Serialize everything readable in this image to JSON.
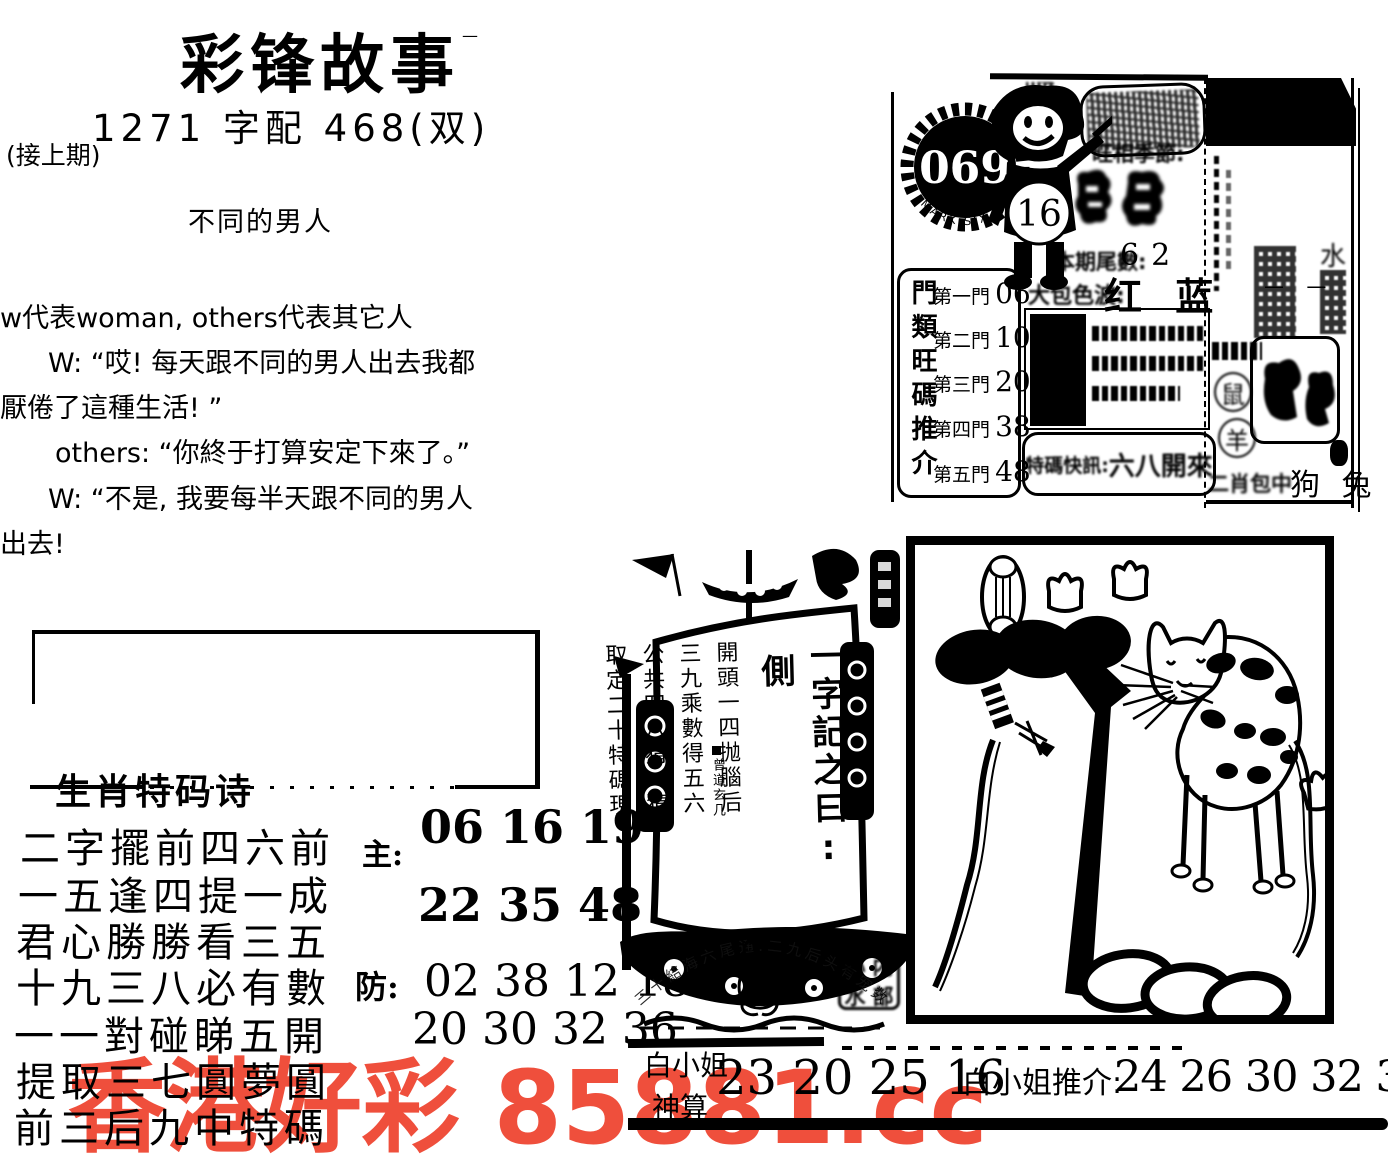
{
  "masthead": {
    "title": "彩锋故事",
    "title_dash": "—",
    "subtitle": "1271 字配 468(双)",
    "continued": "(接上期)",
    "episode_title": "不同的男人"
  },
  "story": {
    "intro": "w代表woman, others代表其它人",
    "lines": [
      "W: “哎! 每天跟不同的男人出去我都",
      "厭倦了這種生活! ”",
      "others: “你終于打算安定下來了。”",
      "W: “不是, 我要每半天跟不同的男人",
      "出去!"
    ]
  },
  "info_panel": {
    "issue_number": "069",
    "ring_text": "MARK SIX",
    "boy_number": "16",
    "zodiac_label": "旺相季節:",
    "tail_label": "本期尾數:",
    "tail_value": "62",
    "wave_label": "大包色波:",
    "wave_values": "红 蓝",
    "gates_title": "門類旺碼推介",
    "gates": [
      {
        "label": "第一門",
        "value": "06"
      },
      {
        "label": "第二門",
        "value": "10"
      },
      {
        "label": "第三門",
        "value": "20"
      },
      {
        "label": "第四門",
        "value": "38"
      },
      {
        "label": "第五門",
        "value": "48"
      }
    ],
    "flash_label": "特碼快訊:",
    "flash_value": "六八開來"
  },
  "side_panel": {
    "dashes": "— —",
    "water_char": "水",
    "circled_rat": "鼠",
    "circled_goat": "羊",
    "bottom_label": "二肖包中",
    "bottom_animals": "狗 兔"
  },
  "ship": {
    "motto_head": "一字記之曰:",
    "motto_char": "側",
    "verses": [
      "開頭一四抛腦后",
      "三九乘數得五六",
      "公共四八猜一猜",
      "取定二十特碼現"
    ],
    "signature": "曾道玄几"
  },
  "stamp": {
    "arc_text": "三十結海六尾通.二九后头有宠数",
    "seal_chars": [
      "心",
      "内",
      "水",
      "部"
    ]
  },
  "poem": {
    "heading": "生肖特码诗",
    "lines": [
      "二字擺前四六前",
      "一五逢四提一成",
      "君心勝勝看三五",
      "十九三八必有數",
      "一一對碰睇五開",
      "提取三七圓夢圓",
      "前三后九中特碼"
    ],
    "main_label": "主:",
    "main_numbers": "06 16 19",
    "line2_numbers": "22 35 48",
    "guard_label": "防:",
    "guard_numbers": "02 38 12 18",
    "line5_numbers": "20 30 32 36"
  },
  "footer": {
    "tipster_name": "白小姐",
    "tipster_title": "神算",
    "tip_numbers": "23 20 25 16",
    "recommend_label": "白小姐推介:",
    "recommend_numbers": "24 26 30 32 36"
  },
  "watermark": {
    "text": "香港好彩 85881.cc",
    "color": "#ef4f3c"
  }
}
